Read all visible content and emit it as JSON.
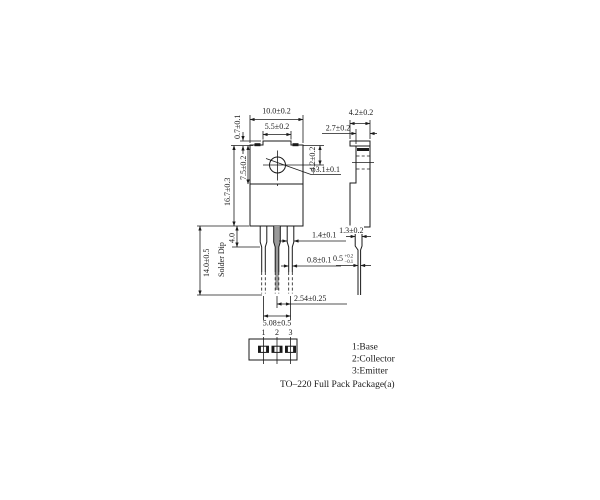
{
  "drawing": {
    "caption": "TO–220 Full Pack Package(a)",
    "legend": {
      "items": [
        "1:Base",
        "2:Collector",
        "3:Emitter"
      ]
    },
    "pins": {
      "labels": [
        "1",
        "2",
        "3"
      ]
    },
    "dims": {
      "front_width": "10.0±0.2",
      "tab_plateau_width": "5.5±0.2",
      "plateau_height": "0.7±0.1",
      "body_height": "16.7±0.3",
      "tab_region_height": "7.5±0.2",
      "hole_center_offset": "4.2±0.2",
      "hole_diameter": "φ3.1±0.1",
      "lead_width_wide": "1.4±0.1",
      "lead_width_narrow": "0.8±0.1",
      "lead_pitch": "2.54±0.25",
      "lead_outer_span": "5.08±0.5",
      "lead_length": "14.0±0.5",
      "solder_dip_label": "Solder Dip",
      "lead_shoulder_length": "4.0",
      "side_total_thickness": "4.2±0.2",
      "side_body_thickness": "2.7±0.2",
      "lead_exit_width": "1.3±0.2",
      "lead_thickness_value": "0.5",
      "lead_thickness_tol_plus": "+0.2",
      "lead_thickness_tol_minus": "−0.1"
    },
    "colors": {
      "line": "#1a1a1a",
      "collector_lead_fill": "#9a9a9a",
      "background": "#ffffff"
    }
  }
}
